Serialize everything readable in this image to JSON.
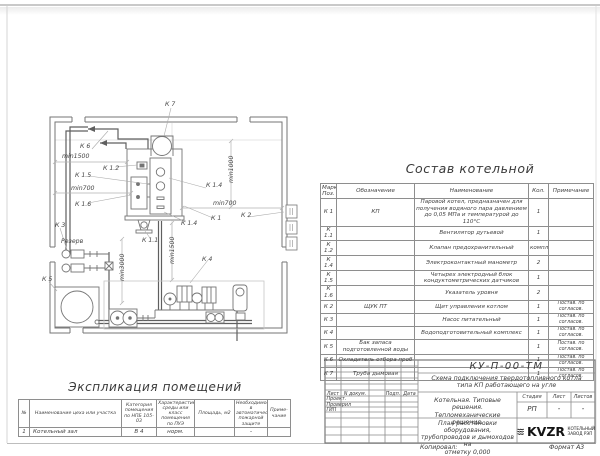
{
  "plan": {
    "labels": [
      "К 7",
      "К 6",
      "min1500",
      "К 1.2",
      "К 1.5",
      "min700",
      "К 1.6",
      "К 3",
      "Резерв",
      "К 5",
      "К 1.1",
      "К 4",
      "К 1.4",
      "min700",
      "К 2",
      "К 1",
      "К 1.4",
      "min1000",
      "min1500",
      "min3000"
    ]
  },
  "sostav": {
    "title": "Состав котельной",
    "headers": {
      "mark": "Марка Поз.",
      "designation": "Обозначение",
      "name": "Наименование",
      "qty": "Кол.",
      "note": "Примечание"
    },
    "rows": [
      {
        "mark": "К 1",
        "designation": "КП",
        "name": "Паровой котел, предназначен для получения водяного пара давлением до 0,05 МПа и температурой до 110°С",
        "qty": "1",
        "note": ""
      },
      {
        "mark": "К 1.1",
        "designation": "",
        "name": "Вентилятор дутьевой",
        "qty": "1",
        "note": ""
      },
      {
        "mark": "К 1.2",
        "designation": "",
        "name": "Клапан предохранительный",
        "qty": "компл.",
        "note": ""
      },
      {
        "mark": "К 1.4",
        "designation": "",
        "name": "Электроконтактный манометр",
        "qty": "2",
        "note": ""
      },
      {
        "mark": "К 1.5",
        "designation": "",
        "name": "Четырех электродный блок кондуктометрических датчиков",
        "qty": "1",
        "note": ""
      },
      {
        "mark": "К 1.6",
        "designation": "",
        "name": "Указатель уровня",
        "qty": "2",
        "note": ""
      },
      {
        "mark": "К 2",
        "designation": "ЩУК ПТ",
        "name": "Щит управления котлом",
        "qty": "1",
        "note": "Постав. по согласов."
      },
      {
        "mark": "К 3",
        "designation": "",
        "name": "Насос питательный",
        "qty": "1",
        "note": "Постав. по согласов."
      },
      {
        "mark": "К 4",
        "designation": "",
        "name": "Водоподготовительный комплекс",
        "qty": "1",
        "note": "Постав. по согласов."
      },
      {
        "mark": "К 5",
        "designation": "Бак запаса подготовленной воды",
        "name": "",
        "qty": "1",
        "note": "Постав. по согласов."
      },
      {
        "mark": "К 6",
        "designation": "Охладитель отбора проб",
        "name": "",
        "qty": "1",
        "note": "Постав. по согласов."
      },
      {
        "mark": "К 7",
        "designation": "Труба дымовая",
        "name": "",
        "qty": "1",
        "note": "Постав. по согласов."
      }
    ]
  },
  "explication": {
    "title": "Экспликация помещений",
    "headers": {
      "num": "№",
      "name": "Наименование цеха или участка",
      "category": "Категория помещения по НПБ 105-03",
      "environment": "Характеристика среды или класс помещения по ПУЭ",
      "area": "Площадь, м2",
      "fire": "Необходимость в автоматической пожарной защите",
      "note": "Приме-чание"
    },
    "rows": [
      {
        "num": "1",
        "name": "Котельный зал",
        "category": "В 4",
        "environment": "норм.",
        "area": "",
        "fire": "-",
        "note": ""
      }
    ]
  },
  "titleblock": {
    "doc_number": "КУ-П-00-ТМ",
    "doc_description_line1": "Схема подключения твердотопливного котла",
    "doc_description_line2": "типа КП работающего на угле",
    "col_sheet": "Лист",
    "col_doc": "N докум.",
    "col_sign": "Подп.",
    "col_date": "Дата",
    "role_1": "Проект.",
    "role_2": "Проверил",
    "role_3": "ГИП",
    "project_line1": "Котельная. Типовые решения.",
    "project_line2": "Тепломеханические решения.",
    "stage_label": "Стадия",
    "sheet_label": "Лист",
    "sheets_label": "Листов",
    "stage_value": "РП",
    "sheet_value": "-",
    "sheets_value": "-",
    "drawing_title_line1": "План расстановки оборудования,",
    "drawing_title_line2": "трубопроводов и дымоходов на",
    "drawing_title_line3": "отметку 0,000",
    "logo_text": "KVZR",
    "company_line1": "КОТЕЛЬНЫЙ",
    "company_line2": "ЗАВОД РЭП"
  },
  "footer": {
    "copied_label": "Копировал:",
    "format_label": "Формат А3"
  }
}
